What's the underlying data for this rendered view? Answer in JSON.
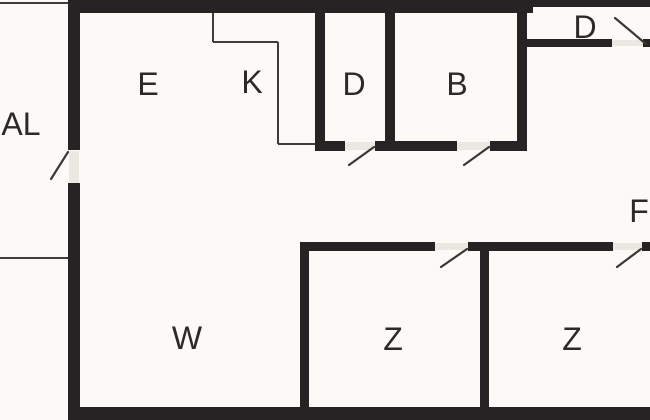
{
  "canvas": {
    "width": 650,
    "height": 420,
    "background": "#fbfaf6"
  },
  "floorplan": {
    "colors": {
      "wall": "#272223",
      "thin_line": "#403c3a",
      "swing": "#3a3634",
      "label": "#2b2a29",
      "threshold": "#eae8e1",
      "background": "#fbfaf6"
    },
    "rooms": [
      {
        "id": "al",
        "label": "AL",
        "x": 21,
        "y": 124,
        "size": 32
      },
      {
        "id": "e",
        "label": "E",
        "x": 148,
        "y": 84,
        "size": 32
      },
      {
        "id": "k",
        "label": "K",
        "x": 252,
        "y": 82,
        "size": 32
      },
      {
        "id": "d",
        "label": "D",
        "x": 354,
        "y": 84,
        "size": 32
      },
      {
        "id": "b",
        "label": "B",
        "x": 457,
        "y": 84,
        "size": 32
      },
      {
        "id": "d-entrance",
        "label": "D",
        "x": 585,
        "y": 27,
        "size": 32
      },
      {
        "id": "f",
        "label": "F",
        "x": 639,
        "y": 211,
        "size": 32
      },
      {
        "id": "w",
        "label": "W",
        "x": 187,
        "y": 338,
        "size": 32
      },
      {
        "id": "z1",
        "label": "Z",
        "x": 393,
        "y": 339,
        "size": 32
      },
      {
        "id": "z2",
        "label": "Z",
        "x": 572,
        "y": 339,
        "size": 32
      }
    ],
    "walls": [
      {
        "name": "outer-top-wall",
        "x": 68,
        "y": 0,
        "w": 465,
        "h": 13
      },
      {
        "name": "outer-top-right-wall",
        "x": 533,
        "y": 0,
        "w": 117,
        "h": 7
      },
      {
        "name": "outer-left-wall-upper",
        "x": 68,
        "y": 0,
        "w": 12,
        "h": 150
      },
      {
        "name": "outer-left-wall-lower",
        "x": 68,
        "y": 183,
        "w": 12,
        "h": 237
      },
      {
        "name": "outer-bottom-wall",
        "x": 68,
        "y": 407,
        "w": 582,
        "h": 13
      },
      {
        "name": "divider-k-d-wall",
        "x": 315,
        "y": 13,
        "w": 10,
        "h": 138
      },
      {
        "name": "d-bottom-wall-left",
        "x": 315,
        "y": 141,
        "w": 30,
        "h": 10
      },
      {
        "name": "d-b-bottom-wall-mid",
        "x": 375,
        "y": 141,
        "w": 82,
        "h": 10
      },
      {
        "name": "divider-d-b-wall",
        "x": 385,
        "y": 13,
        "w": 10,
        "h": 128
      },
      {
        "name": "b-bottom-wall-right",
        "x": 490,
        "y": 141,
        "w": 37,
        "h": 10
      },
      {
        "name": "b-right-wall",
        "x": 517,
        "y": 0,
        "w": 10,
        "h": 151
      },
      {
        "name": "entrance-wall",
        "x": 527,
        "y": 39,
        "w": 85,
        "h": 8
      },
      {
        "name": "entrance-wall-stub",
        "x": 643,
        "y": 39,
        "w": 7,
        "h": 8
      },
      {
        "name": "z1-left-wall",
        "x": 300,
        "y": 242,
        "w": 9,
        "h": 178
      },
      {
        "name": "z1-top-wall",
        "x": 300,
        "y": 242,
        "w": 135,
        "h": 9
      },
      {
        "name": "z-top-wall-mid",
        "x": 468,
        "y": 242,
        "w": 145,
        "h": 9
      },
      {
        "name": "z-top-wall-stub",
        "x": 642,
        "y": 242,
        "w": 8,
        "h": 9
      },
      {
        "name": "divider-z1-z2-wall",
        "x": 480,
        "y": 242,
        "w": 9,
        "h": 178
      }
    ],
    "thin_lines": [
      {
        "name": "al-boundary-top",
        "x1": 0,
        "y1": 3,
        "x2": 68,
        "y2": 3
      },
      {
        "name": "al-boundary-bottom",
        "x1": 0,
        "y1": 258,
        "x2": 68,
        "y2": 258
      },
      {
        "name": "k-niche-line-v1",
        "x1": 213,
        "y1": 13,
        "x2": 213,
        "y2": 42
      },
      {
        "name": "k-niche-line-h1",
        "x1": 213,
        "y1": 42,
        "x2": 278,
        "y2": 42
      },
      {
        "name": "k-niche-line-v2",
        "x1": 278,
        "y1": 42,
        "x2": 278,
        "y2": 144
      },
      {
        "name": "k-niche-line-h2",
        "x1": 278,
        "y1": 144,
        "x2": 315,
        "y2": 144
      }
    ],
    "thresholds": [
      {
        "name": "door-al-threshold",
        "x": 69,
        "y": 151,
        "w": 10,
        "h": 32
      },
      {
        "name": "door-d-threshold",
        "x": 345,
        "y": 142,
        "w": 30,
        "h": 8
      },
      {
        "name": "door-b-threshold",
        "x": 457,
        "y": 142,
        "w": 33,
        "h": 8
      },
      {
        "name": "door-z1-threshold",
        "x": 435,
        "y": 243,
        "w": 33,
        "h": 7
      },
      {
        "name": "door-z2-threshold",
        "x": 613,
        "y": 243,
        "w": 29,
        "h": 7
      },
      {
        "name": "door-entrance-threshold",
        "x": 612,
        "y": 40,
        "w": 31,
        "h": 6
      }
    ],
    "door_swings": [
      {
        "name": "door-al-swing",
        "x1": 68,
        "y1": 152,
        "x2": 51,
        "y2": 179
      },
      {
        "name": "door-d-swing",
        "x1": 374,
        "y1": 147,
        "x2": 349,
        "y2": 165
      },
      {
        "name": "door-b-swing",
        "x1": 489,
        "y1": 147,
        "x2": 464,
        "y2": 165
      },
      {
        "name": "door-z1-swing",
        "x1": 467,
        "y1": 249,
        "x2": 441,
        "y2": 267
      },
      {
        "name": "door-z2-swing",
        "x1": 641,
        "y1": 249,
        "x2": 617,
        "y2": 267
      },
      {
        "name": "door-entrance-swing",
        "x1": 646,
        "y1": 44,
        "x2": 615,
        "y2": 18
      }
    ]
  }
}
